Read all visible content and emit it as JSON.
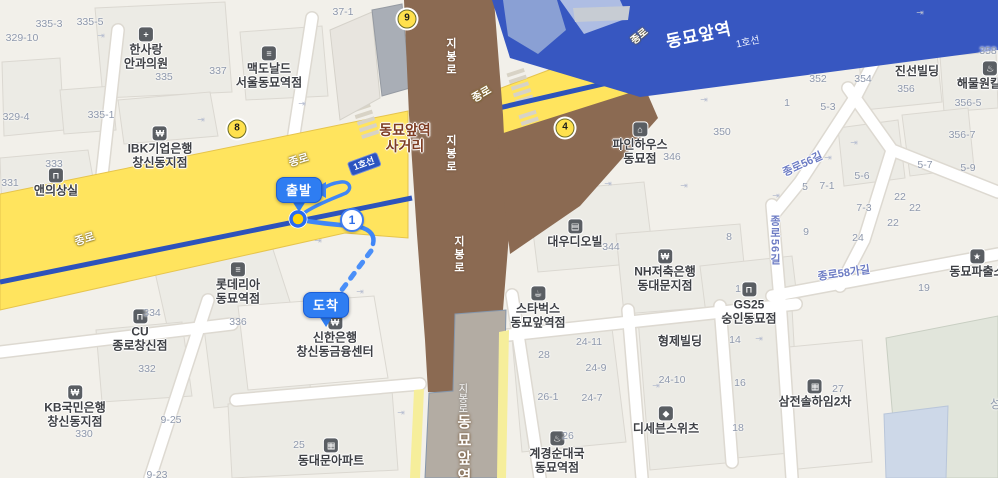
{
  "route": {
    "start_label": "출발",
    "end_label": "도착",
    "waypoint_label": "1"
  },
  "exits": [
    {
      "n": "9",
      "x": 407,
      "y": 19
    },
    {
      "n": "8",
      "x": 237,
      "y": 129
    },
    {
      "n": "4",
      "x": 565,
      "y": 128
    }
  ],
  "labels": [
    {
      "t": "poi",
      "name": "poi-hansarang-eye-clinic",
      "x": 146,
      "y": 49,
      "lines": [
        "한사랑",
        "안과의원"
      ],
      "icon": "+",
      "icon_name": "hospital-icon"
    },
    {
      "t": "poi",
      "name": "poi-mcdonalds-seouldongmyo",
      "x": 269,
      "y": 68,
      "lines": [
        "맥도날드",
        "서울동묘역점"
      ],
      "icon": "≡",
      "icon_name": "burger-icon"
    },
    {
      "t": "poi",
      "name": "poi-aenui-sangsil",
      "x": 56,
      "y": 183,
      "lines": [
        "앤의상실"
      ],
      "icon": "⊓",
      "icon_name": "bag-icon"
    },
    {
      "t": "poi",
      "name": "poi-ibk-bank-changsin",
      "x": 160,
      "y": 148,
      "lines": [
        "IBK기업은행",
        "창신동지점"
      ],
      "icon": "₩",
      "icon_name": "won-icon"
    },
    {
      "t": "poi",
      "name": "poi-lotteria-dongmyo",
      "x": 238,
      "y": 284,
      "lines": [
        "롯데리아",
        "동묘역점"
      ],
      "icon": "≡",
      "icon_name": "burger-icon"
    },
    {
      "t": "poi",
      "name": "poi-cu-jongnochangsin",
      "x": 140,
      "y": 331,
      "lines": [
        "CU",
        "종로창신점"
      ],
      "icon": "⊓",
      "icon_name": "bag-icon"
    },
    {
      "t": "poi",
      "name": "poi-kb-bank-changsin",
      "x": 75,
      "y": 407,
      "lines": [
        "KB국민은행",
        "창신동지점"
      ],
      "icon": "₩",
      "icon_name": "won-icon"
    },
    {
      "t": "poi",
      "name": "poi-shinhan-bank-changsin",
      "x": 335,
      "y": 337,
      "lines": [
        "신한은행",
        "창신동금융센터"
      ],
      "icon": "₩",
      "icon_name": "won-icon"
    },
    {
      "t": "poi",
      "name": "poi-dongdaemun-apartment",
      "x": 331,
      "y": 453,
      "lines": [
        "동대문아파트"
      ],
      "icon": "▦",
      "icon_name": "apartment-icon"
    },
    {
      "t": "poi",
      "name": "poi-daewoo-dioville",
      "x": 575,
      "y": 234,
      "lines": [
        "대우디오빌"
      ],
      "icon": "▤",
      "icon_name": "building-icon"
    },
    {
      "t": "poi",
      "name": "poi-nh-bank-dongdaemun",
      "x": 665,
      "y": 271,
      "lines": [
        "NH저축은행",
        "동대문지점"
      ],
      "icon": "₩",
      "icon_name": "won-icon"
    },
    {
      "t": "poi",
      "name": "poi-pinehouse-dongmyo",
      "x": 640,
      "y": 144,
      "lines": [
        "파인하우스",
        "동묘점"
      ],
      "icon": "⌂",
      "icon_name": "home-icon"
    },
    {
      "t": "poi",
      "name": "poi-jinsun-building",
      "x": 917,
      "y": 71,
      "lines": [
        "진선빌딩"
      ]
    },
    {
      "t": "poi",
      "name": "poi-haemulwon-kalguksu",
      "x": 990,
      "y": 76,
      "lines": [
        "해물원칼국수"
      ],
      "icon": "♨",
      "icon_name": "pot-icon"
    },
    {
      "t": "poi",
      "name": "poi-starbucks-dongmyo",
      "x": 538,
      "y": 308,
      "lines": [
        "스타벅스",
        "동묘앞역점"
      ],
      "icon": "☕",
      "icon_name": "coffee-icon"
    },
    {
      "t": "poi",
      "name": "poi-gs25-sungindongmyo",
      "x": 749,
      "y": 304,
      "lines": [
        "GS25",
        "숭인동묘점"
      ],
      "icon": "⊓",
      "icon_name": "bag-icon"
    },
    {
      "t": "poi",
      "name": "poi-hyungje-building",
      "x": 680,
      "y": 341,
      "lines": [
        "형제빌딩"
      ]
    },
    {
      "t": "poi",
      "name": "poi-dseven-sweets",
      "x": 666,
      "y": 421,
      "lines": [
        "디세븐스위츠"
      ],
      "icon": "◆",
      "icon_name": "dessert-icon"
    },
    {
      "t": "poi",
      "name": "poi-gyegyeong-sundae",
      "x": 557,
      "y": 453,
      "lines": [
        "계경순대국",
        "동묘역점"
      ],
      "icon": "♨",
      "icon_name": "pot-icon"
    },
    {
      "t": "poi",
      "name": "poi-samjeon-solhaim2",
      "x": 815,
      "y": 394,
      "lines": [
        "삼전솔하임2차"
      ],
      "icon": "▦",
      "icon_name": "apartment-icon"
    },
    {
      "t": "poi",
      "name": "poi-dongmyo-police",
      "x": 977,
      "y": 264,
      "lines": [
        "동묘파출소"
      ],
      "icon": "★",
      "icon_name": "police-icon"
    },
    {
      "t": "inter",
      "name": "intersection-name",
      "x": 405,
      "y": 138,
      "lines": [
        "동묘앞역",
        "사거리"
      ]
    },
    {
      "t": "lot",
      "x": 49,
      "y": 24,
      "text": "335-3"
    },
    {
      "t": "lot",
      "x": 22,
      "y": 38,
      "text": "329-10"
    },
    {
      "t": "lot",
      "x": 90,
      "y": 22,
      "text": "335-5"
    },
    {
      "t": "lot",
      "x": 164,
      "y": 77,
      "text": "335"
    },
    {
      "t": "lot",
      "x": 218,
      "y": 71,
      "text": "337"
    },
    {
      "t": "lot",
      "x": 101,
      "y": 115,
      "text": "335-1"
    },
    {
      "t": "lot",
      "x": 16,
      "y": 117,
      "text": "329-4"
    },
    {
      "t": "lot",
      "x": 54,
      "y": 164,
      "text": "333"
    },
    {
      "t": "lot",
      "x": 10,
      "y": 183,
      "text": "331"
    },
    {
      "t": "lot",
      "x": 343,
      "y": 12,
      "text": "37-1"
    },
    {
      "t": "lot",
      "x": 722,
      "y": 132,
      "text": "350"
    },
    {
      "t": "lot",
      "x": 818,
      "y": 79,
      "text": "352"
    },
    {
      "t": "lot",
      "x": 863,
      "y": 79,
      "text": "354"
    },
    {
      "t": "lot",
      "x": 787,
      "y": 103,
      "text": "1"
    },
    {
      "t": "lot",
      "x": 828,
      "y": 107,
      "text": "5-3"
    },
    {
      "t": "lot",
      "x": 988,
      "y": 51,
      "text": "358"
    },
    {
      "t": "lot",
      "x": 906,
      "y": 89,
      "text": "356"
    },
    {
      "t": "lot",
      "x": 968,
      "y": 103,
      "text": "356-5"
    },
    {
      "t": "lot",
      "x": 962,
      "y": 135,
      "text": "356-7"
    },
    {
      "t": "lot",
      "x": 862,
      "y": 176,
      "text": "5-6"
    },
    {
      "t": "lot",
      "x": 925,
      "y": 165,
      "text": "5-7"
    },
    {
      "t": "lot",
      "x": 968,
      "y": 168,
      "text": "5-9"
    },
    {
      "t": "lot",
      "x": 805,
      "y": 187,
      "text": "5"
    },
    {
      "t": "lot",
      "x": 827,
      "y": 186,
      "text": "7-1"
    },
    {
      "t": "lot",
      "x": 864,
      "y": 208,
      "text": "7-3"
    },
    {
      "t": "lot",
      "x": 900,
      "y": 197,
      "text": "22"
    },
    {
      "t": "lot",
      "x": 915,
      "y": 208,
      "text": "22"
    },
    {
      "t": "lot",
      "x": 893,
      "y": 223,
      "text": "22"
    },
    {
      "t": "lot",
      "x": 858,
      "y": 238,
      "text": "24"
    },
    {
      "t": "lot",
      "x": 806,
      "y": 232,
      "text": "9"
    },
    {
      "t": "lot",
      "x": 924,
      "y": 288,
      "text": "19"
    },
    {
      "t": "lot",
      "x": 735,
      "y": 340,
      "text": "14"
    },
    {
      "t": "lot",
      "x": 740,
      "y": 383,
      "text": "16"
    },
    {
      "t": "lot",
      "x": 738,
      "y": 428,
      "text": "18"
    },
    {
      "t": "lot",
      "x": 589,
      "y": 342,
      "text": "24-11"
    },
    {
      "t": "lot",
      "x": 596,
      "y": 368,
      "text": "24-9"
    },
    {
      "t": "lot",
      "x": 592,
      "y": 398,
      "text": "24-7"
    },
    {
      "t": "lot",
      "x": 548,
      "y": 397,
      "text": "26-1"
    },
    {
      "t": "lot",
      "x": 672,
      "y": 380,
      "text": "24-10"
    },
    {
      "t": "lot",
      "x": 544,
      "y": 355,
      "text": "28"
    },
    {
      "t": "lot",
      "x": 568,
      "y": 436,
      "text": "26"
    },
    {
      "t": "lot",
      "x": 238,
      "y": 322,
      "text": "336"
    },
    {
      "t": "lot",
      "x": 152,
      "y": 313,
      "text": "334"
    },
    {
      "t": "lot",
      "x": 147,
      "y": 369,
      "text": "332"
    },
    {
      "t": "lot",
      "x": 84,
      "y": 434,
      "text": "330"
    },
    {
      "t": "lot",
      "x": 171,
      "y": 420,
      "text": "9-25"
    },
    {
      "t": "lot",
      "x": 157,
      "y": 475,
      "text": "9-23"
    },
    {
      "t": "lot",
      "x": 299,
      "y": 445,
      "text": "25"
    },
    {
      "t": "lot",
      "x": 611,
      "y": 247,
      "text": "344"
    },
    {
      "t": "lot",
      "x": 672,
      "y": 157,
      "text": "346"
    },
    {
      "t": "lot",
      "x": 838,
      "y": 389,
      "text": "27"
    },
    {
      "t": "lot",
      "x": 738,
      "y": 289,
      "text": "1"
    },
    {
      "t": "lot",
      "x": 729,
      "y": 237,
      "text": "8"
    },
    {
      "t": "lot",
      "x": 1001,
      "y": 404,
      "text": "성사",
      "fs": 12
    },
    {
      "t": "rw",
      "name": "road-label-jongno",
      "x": 85,
      "y": 240,
      "text": "종로",
      "rot": -17
    },
    {
      "t": "rw",
      "name": "road-label-jongno",
      "x": 299,
      "y": 161,
      "text": "종로",
      "rot": -17
    },
    {
      "t": "rw",
      "name": "road-label-jongno",
      "x": 482,
      "y": 95,
      "text": "종로",
      "rot": -30
    },
    {
      "t": "rw",
      "name": "road-label-jongno",
      "x": 640,
      "y": 37,
      "text": "종로",
      "rot": -40,
      "fs": 10
    },
    {
      "t": "rail-big",
      "name": "station-name-dongmyo",
      "x": 699,
      "y": 36,
      "text": "동묘앞역",
      "rot": -12
    },
    {
      "t": "rail-small",
      "name": "railway-line1-label",
      "x": 748,
      "y": 43,
      "text": "1호선",
      "rot": -12
    },
    {
      "t": "line-badge",
      "name": "subway-line1-badge",
      "x": 364,
      "y": 164,
      "text": "1호선",
      "rot": -20
    },
    {
      "t": "vb",
      "name": "road-label-jibongro",
      "x": 450,
      "y": 57,
      "text": "지봉로"
    },
    {
      "t": "vb",
      "name": "road-label-jibongro",
      "x": 450,
      "y": 154,
      "text": "지봉로"
    },
    {
      "t": "vb",
      "name": "road-label-jibongro",
      "x": 458,
      "y": 255,
      "text": "지봉로"
    },
    {
      "t": "vg",
      "name": "road-label-jibongro",
      "x": 461,
      "y": 398,
      "text": "지봉로"
    },
    {
      "t": "vs",
      "name": "station-road-dongmyo",
      "x": 463,
      "y": 450,
      "text": "동묘앞역"
    },
    {
      "t": "rb",
      "name": "road-label-jongno56gil",
      "x": 803,
      "y": 165,
      "text": "종로56길",
      "rot": -25
    },
    {
      "t": "rbv",
      "name": "road-label-jongno56gil",
      "x": 774,
      "y": 240,
      "text": "종로56길"
    },
    {
      "t": "rb",
      "name": "road-label-jongno58gagil",
      "x": 844,
      "y": 274,
      "text": "종로58가길",
      "rot": -8
    },
    {
      "t": "door",
      "x": 101,
      "y": 36,
      "text": "⇥"
    },
    {
      "t": "door",
      "x": 201,
      "y": 120,
      "text": "⇥"
    },
    {
      "t": "door",
      "x": 302,
      "y": 104,
      "text": "⇥"
    },
    {
      "t": "door",
      "x": 318,
      "y": 241,
      "text": "⇥"
    },
    {
      "t": "door",
      "x": 360,
      "y": 292,
      "text": "⇥"
    },
    {
      "t": "door",
      "x": 704,
      "y": 100,
      "text": "⇥"
    },
    {
      "t": "door",
      "x": 828,
      "y": 158,
      "text": "⇥"
    },
    {
      "t": "door",
      "x": 776,
      "y": 196,
      "text": "⇥"
    },
    {
      "t": "door",
      "x": 608,
      "y": 184,
      "text": "⇥"
    },
    {
      "t": "door",
      "x": 684,
      "y": 186,
      "text": "⇥"
    },
    {
      "t": "door",
      "x": 920,
      "y": 13,
      "text": "⇥"
    },
    {
      "t": "door",
      "x": 854,
      "y": 143,
      "text": "⇥"
    },
    {
      "t": "door",
      "x": 401,
      "y": 413,
      "text": "⇥"
    },
    {
      "t": "door",
      "x": 656,
      "y": 386,
      "text": "⇥"
    },
    {
      "t": "door",
      "x": 759,
      "y": 339,
      "text": "⇥"
    }
  ],
  "colors": {
    "background": "#f2f0ea",
    "major_road_yellow": "#ffe45e",
    "subway_line1_blue": "#2d53bb",
    "railway_band_blue": "#3757c1",
    "overpass_brown": "#8b6a52",
    "station_road_gray": "#b3aca3",
    "route_blue": "#3f86f7",
    "pin_blue": "#2e7df2",
    "exit_badge_yellow": "#ffe14d"
  }
}
